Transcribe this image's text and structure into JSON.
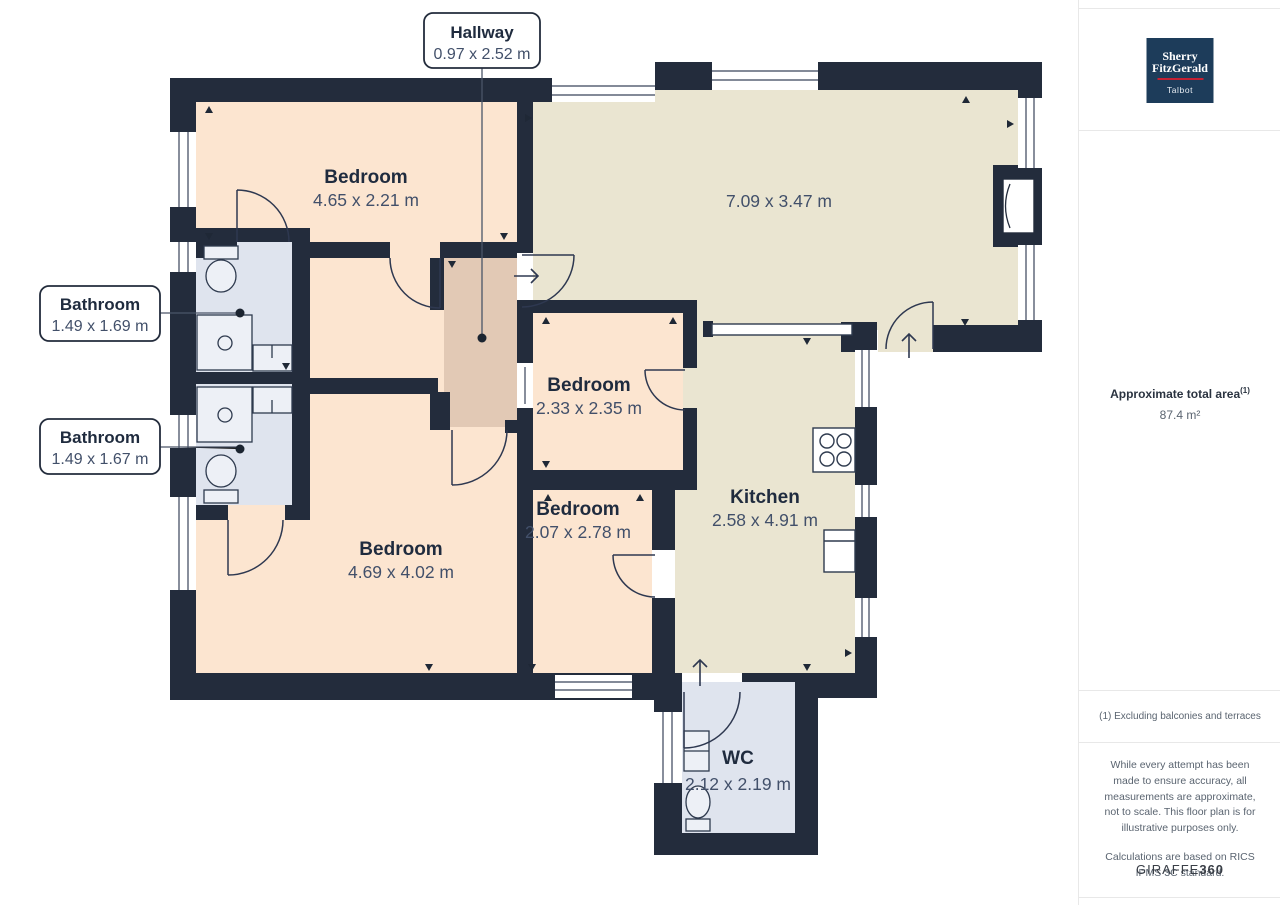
{
  "plan": {
    "callouts": {
      "hallway": {
        "name": "Hallway",
        "dims": "0.97 x 2.52 m"
      },
      "bathroom_top": {
        "name": "Bathroom",
        "dims": "1.49 x 1.69 m"
      },
      "bathroom_bottom": {
        "name": "Bathroom",
        "dims": "1.49 x 1.67 m"
      }
    },
    "rooms": {
      "bedroom_top": {
        "name": "Bedroom",
        "dims": "4.65 x 2.21 m"
      },
      "living": {
        "dims": "7.09 x 3.47 m"
      },
      "bedroom_middle": {
        "name": "Bedroom",
        "dims": "2.33 x 2.35 m"
      },
      "bedroom_small": {
        "name": "Bedroom",
        "dims": "2.07 x 2.78 m"
      },
      "bedroom_large": {
        "name": "Bedroom",
        "dims": "4.69 x 4.02 m"
      },
      "kitchen": {
        "name": "Kitchen",
        "dims": "2.58 x 4.91 m"
      },
      "wc": {
        "name": "WC",
        "dims": "2.12 x 2.19 m"
      }
    },
    "colors": {
      "wall": "#232c3c",
      "floor_bedroom": "#fce5d0",
      "floor_living": "#eae5d1",
      "floor_hallway": "#e2c9b5",
      "floor_wet": "#dfe4ee",
      "label_dark": "#1f2b3e",
      "label_dim": "#42506a"
    }
  },
  "sidebar": {
    "logo": {
      "line1": "Sherry",
      "line2": "FitzGerald",
      "office": "Talbot"
    },
    "area_label": "Approximate total area",
    "area_superscript": "(1)",
    "area_value": "87.4 m²",
    "footnote": "(1) Excluding balconies and terraces",
    "disclaimer1": "While every attempt has been made to ensure accuracy, all measurements are approximate, not to scale. This floor plan is for illustrative purposes only.",
    "disclaimer2": "Calculations are based on RICS IPMS 3C standard.",
    "brand": {
      "name": "GIRAFFE",
      "suffix": "360"
    }
  }
}
